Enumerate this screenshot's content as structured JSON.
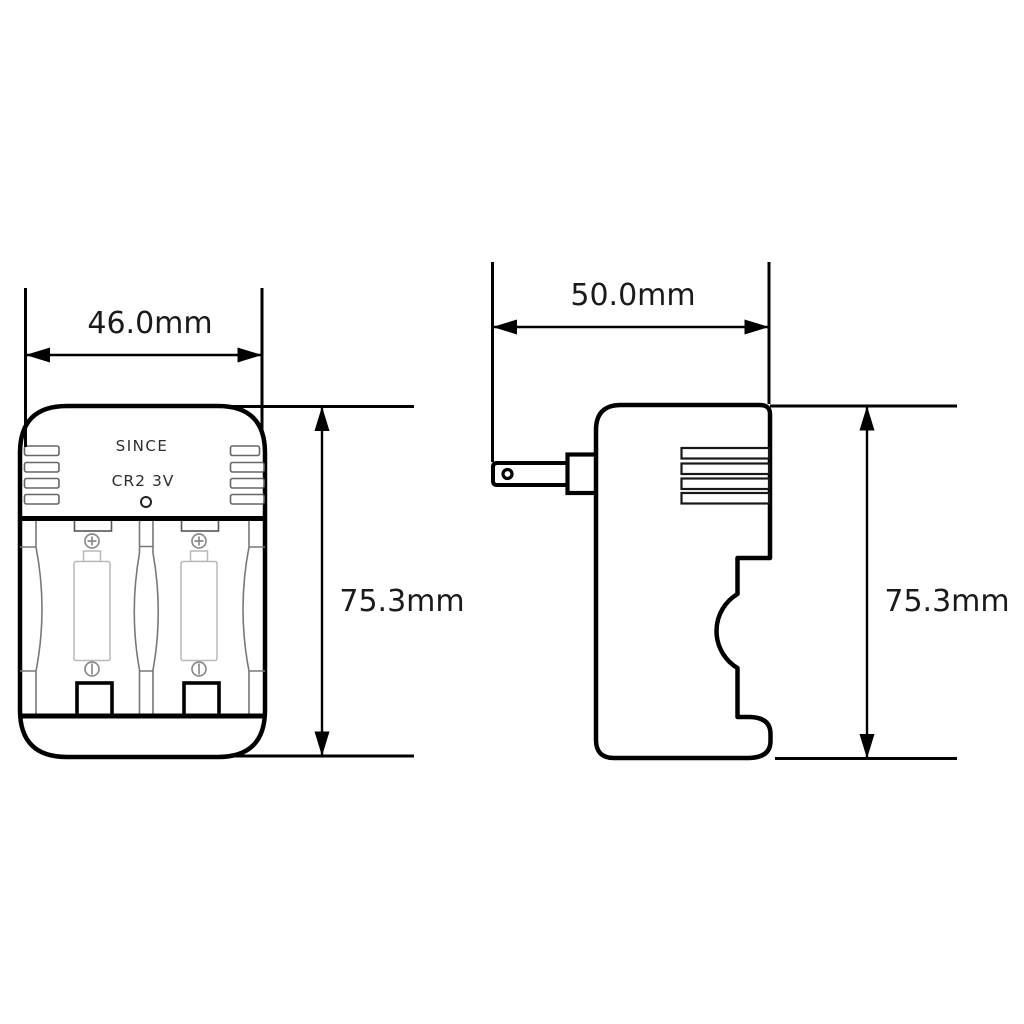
{
  "drawing": {
    "front_view": {
      "brand": "SINCE",
      "model": "CR2 3V"
    },
    "dimensions": {
      "front_width": "46.0mm",
      "front_height": "75.3mm",
      "side_width": "50.0mm",
      "side_height": "75.3mm"
    },
    "colors": {
      "outline": "#000000",
      "detail_gray": "#787878",
      "battery_gray": "#b9b9b9",
      "background": "#ffffff"
    }
  }
}
